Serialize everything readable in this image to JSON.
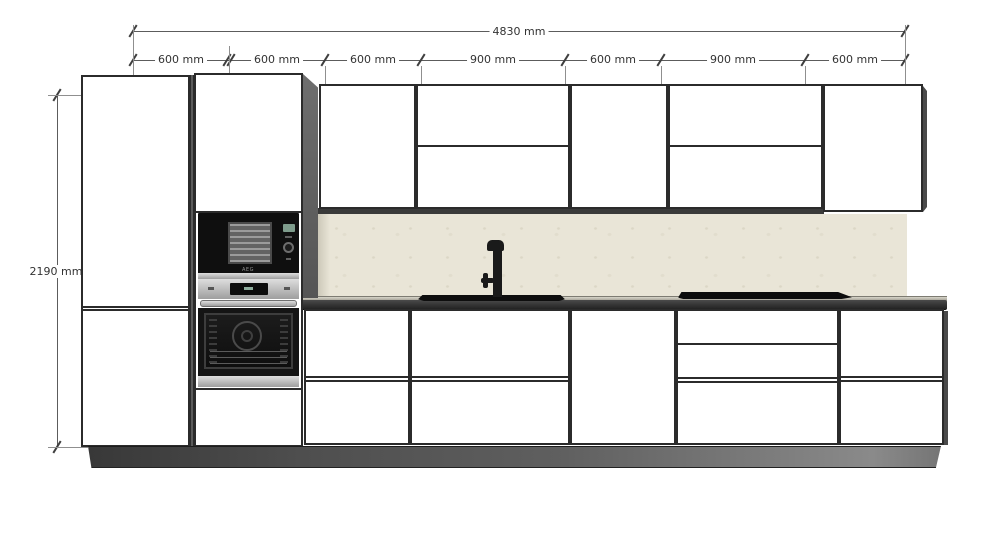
{
  "diagram": {
    "type": "kitchen-elevation-drawing",
    "dimensions": {
      "total_width": {
        "label": "4830 mm"
      },
      "height": {
        "label": "2190 mm"
      },
      "segments": [
        {
          "label": "600 mm"
        },
        {
          "label": "600 mm"
        },
        {
          "label": "600 mm"
        },
        {
          "label": "900 mm"
        },
        {
          "label": "600 mm"
        },
        {
          "label": "900 mm"
        },
        {
          "label": "600 mm"
        }
      ]
    },
    "appliances": {
      "microwave": {
        "brand": "AEG"
      }
    },
    "colors": {
      "background": "#ffffff",
      "cabinet_fill": "#ffffff",
      "cabinet_border": "#2b2b2b",
      "backsplash": "#e9e5d7",
      "counter_front": "#2e2e2e",
      "side_panel": "#5f5f5f",
      "plinth_dark": "#3a3a3a",
      "plinth_light": "#8a8a8a",
      "appliance_black": "#101010",
      "stainless": "#c4c4c4",
      "microwave_display": "#7e9c8c",
      "dimension_line": "#5c5c5c",
      "dimension_text": "#333333"
    }
  }
}
